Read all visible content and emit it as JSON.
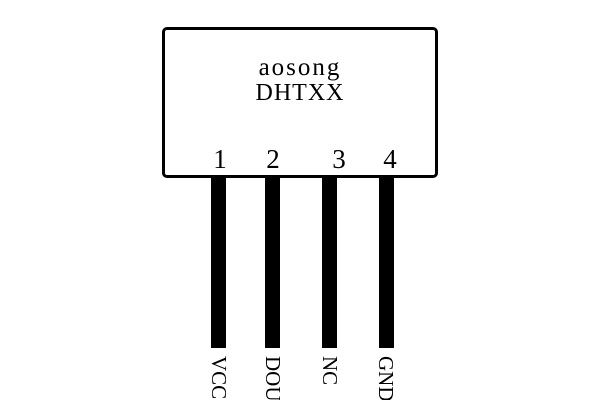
{
  "diagram": {
    "type": "pinout",
    "chip": {
      "manufacturer": "aosong",
      "model": "DHTXX"
    },
    "pins": [
      {
        "number": "1",
        "label": "VCC"
      },
      {
        "number": "2",
        "label": "DOUT"
      },
      {
        "number": "3",
        "label": "NC"
      },
      {
        "number": "4",
        "label": "GND"
      }
    ],
    "colors": {
      "line": "#000000",
      "background": "#ffffff"
    }
  }
}
